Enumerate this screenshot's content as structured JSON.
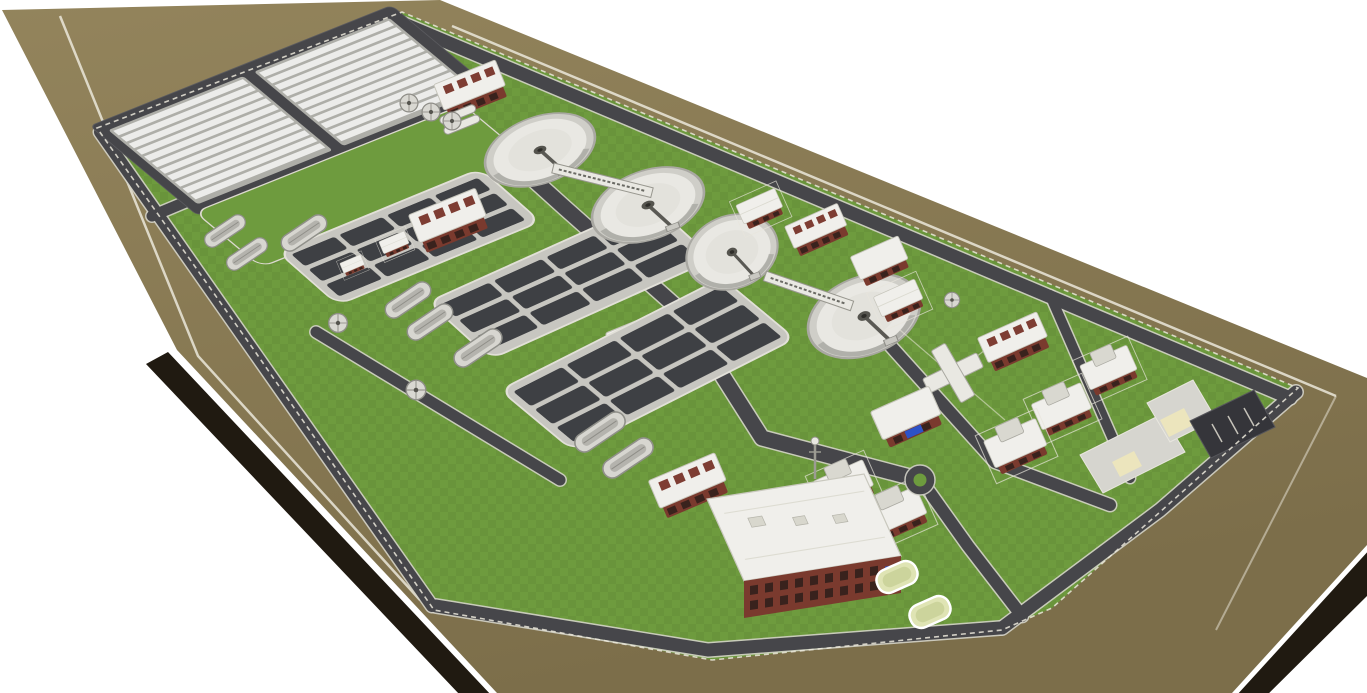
{
  "image": {
    "type": "3d-rendering",
    "subject": "Aerial oblique rendering of a wastewater treatment plant site model",
    "view": "site slab recedes toward upper-left over a plain white background",
    "background": "#ffffff"
  },
  "site": {
    "ground_color": "#8b7b54",
    "edge_color": "#201a11",
    "boundary_line_color": "#ebe7db",
    "lawn_color": "#6e9b3e",
    "road_color": "#46464a",
    "curb_color": "#d3d2c8",
    "concrete_color": "#d6d5cf",
    "concrete_light_color": "#e9e8e2",
    "basin_cell_color": "#3e4044",
    "drying_bed_color": "#ececea",
    "bed_base_color": "#aeaea8",
    "brick_color": "#7a3a2e",
    "roof_color": "#f0efeb",
    "window_color": "#39221d",
    "parking_color": "#35353a",
    "pond_color": "#dfe4b4",
    "pad_color": "#ece5bd",
    "accent_blue": "#2c52c8"
  },
  "facilities": {
    "sludge_drying_bed_arrays": 2,
    "beds_per_array": 11,
    "circular_clarifiers": 4,
    "aeration_basin_complexes": 3,
    "oxidation_ditch_tanks": 8,
    "gravity_thickeners": 3,
    "inlet_round_tanks": 3,
    "blower_buildings": 3,
    "small_utility_buildings": 11,
    "administration_buildings": 1,
    "treatment_ponds": 2,
    "roundabouts": 1,
    "parking_lots": 1,
    "cross_shaped_structures": 1
  }
}
